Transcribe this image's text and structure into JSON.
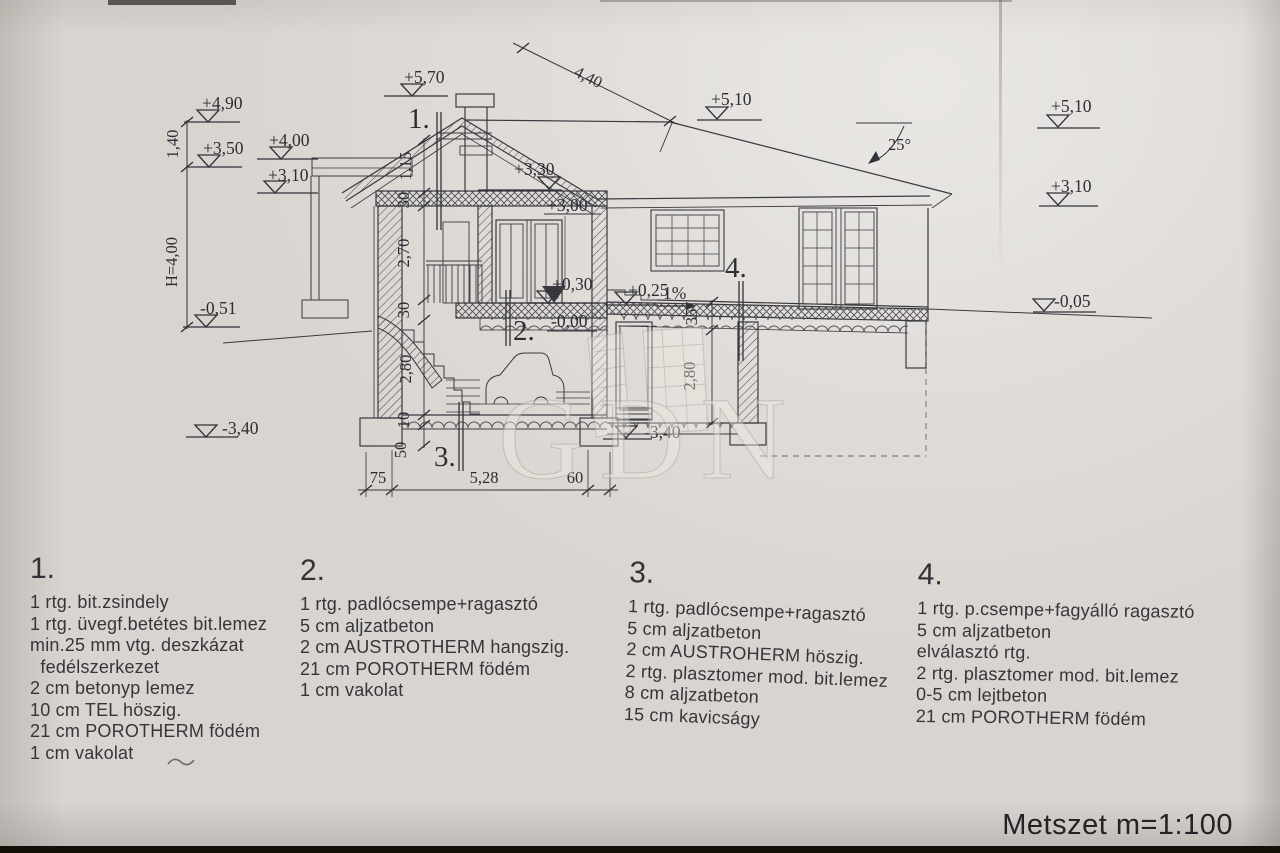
{
  "title": {
    "text": "Metszet m=1:100"
  },
  "watermark": {
    "text": "GDN"
  },
  "markers": {
    "m570": "+5,70",
    "m490": "+4,90",
    "m350": "+3,50",
    "m400": "+4,00",
    "m310_left": "+3,10",
    "m051": "-0,51",
    "m340_left": "-3,40",
    "m330": "+3,30",
    "m300": "+3,00",
    "m030": "+0,30",
    "m000": "-0,00",
    "m025": "+0,25",
    "slope_1pct": "1%",
    "m340_mid": "-3,40",
    "m510_mid": "+5,10",
    "m510_right": "+5,10",
    "m310_right": "+3,10",
    "m005": "-0,05"
  },
  "dims": {
    "roof_span": "4,40",
    "d140": "1,40",
    "height_total": "H=4,00",
    "d115": "1,15",
    "d30_attic": "30",
    "d270": "2,70",
    "d30_floor": "30",
    "d280_left": "2,80",
    "d10": "10",
    "d50": "50",
    "d35": "35",
    "d280_right": "2,80",
    "d75": "75",
    "d528": "5,28",
    "d60": "60",
    "roof_angle": "25°"
  },
  "callouts": {
    "c1": "1.",
    "c2": "2.",
    "c3": "3.",
    "c4": "4."
  },
  "notes": [
    {
      "num": "1.",
      "lines": [
        "1 rtg. bit.zsindely",
        "1 rtg. üvegf.betétes bit.lemez",
        "min.25 mm vtg. deszkázat",
        "  fedélszerkezet",
        "2 cm betonyp lemez",
        "10 cm TEL höszig.",
        "21 cm POROTHERM födém",
        "1 cm vakolat"
      ]
    },
    {
      "num": "2.",
      "lines": [
        "1 rtg. padlócsempe+ragasztó",
        "5 cm aljzatbeton",
        "2 cm AUSTROTHERM hangszig.",
        "21 cm POROTHERM födém",
        "1 cm vakolat"
      ]
    },
    {
      "num": "3.",
      "lines": [
        "1 rtg. padlócsempe+ragasztó",
        "5 cm aljzatbeton",
        "2 cm AUSTROHERM höszig.",
        "2 rtg. plasztomer mod. bit.lemez",
        "8 cm aljzatbeton",
        "15 cm kavicságy"
      ]
    },
    {
      "num": "4.",
      "lines": [
        "1 rtg. p.csempe+fagyálló ragasztó",
        "5 cm aljzatbeton",
        "elválasztó rtg.",
        "2 rtg. plasztomer mod. bit.lemez",
        "0-5 cm lejtbeton",
        "21 cm POROTHERM födém"
      ]
    }
  ]
}
